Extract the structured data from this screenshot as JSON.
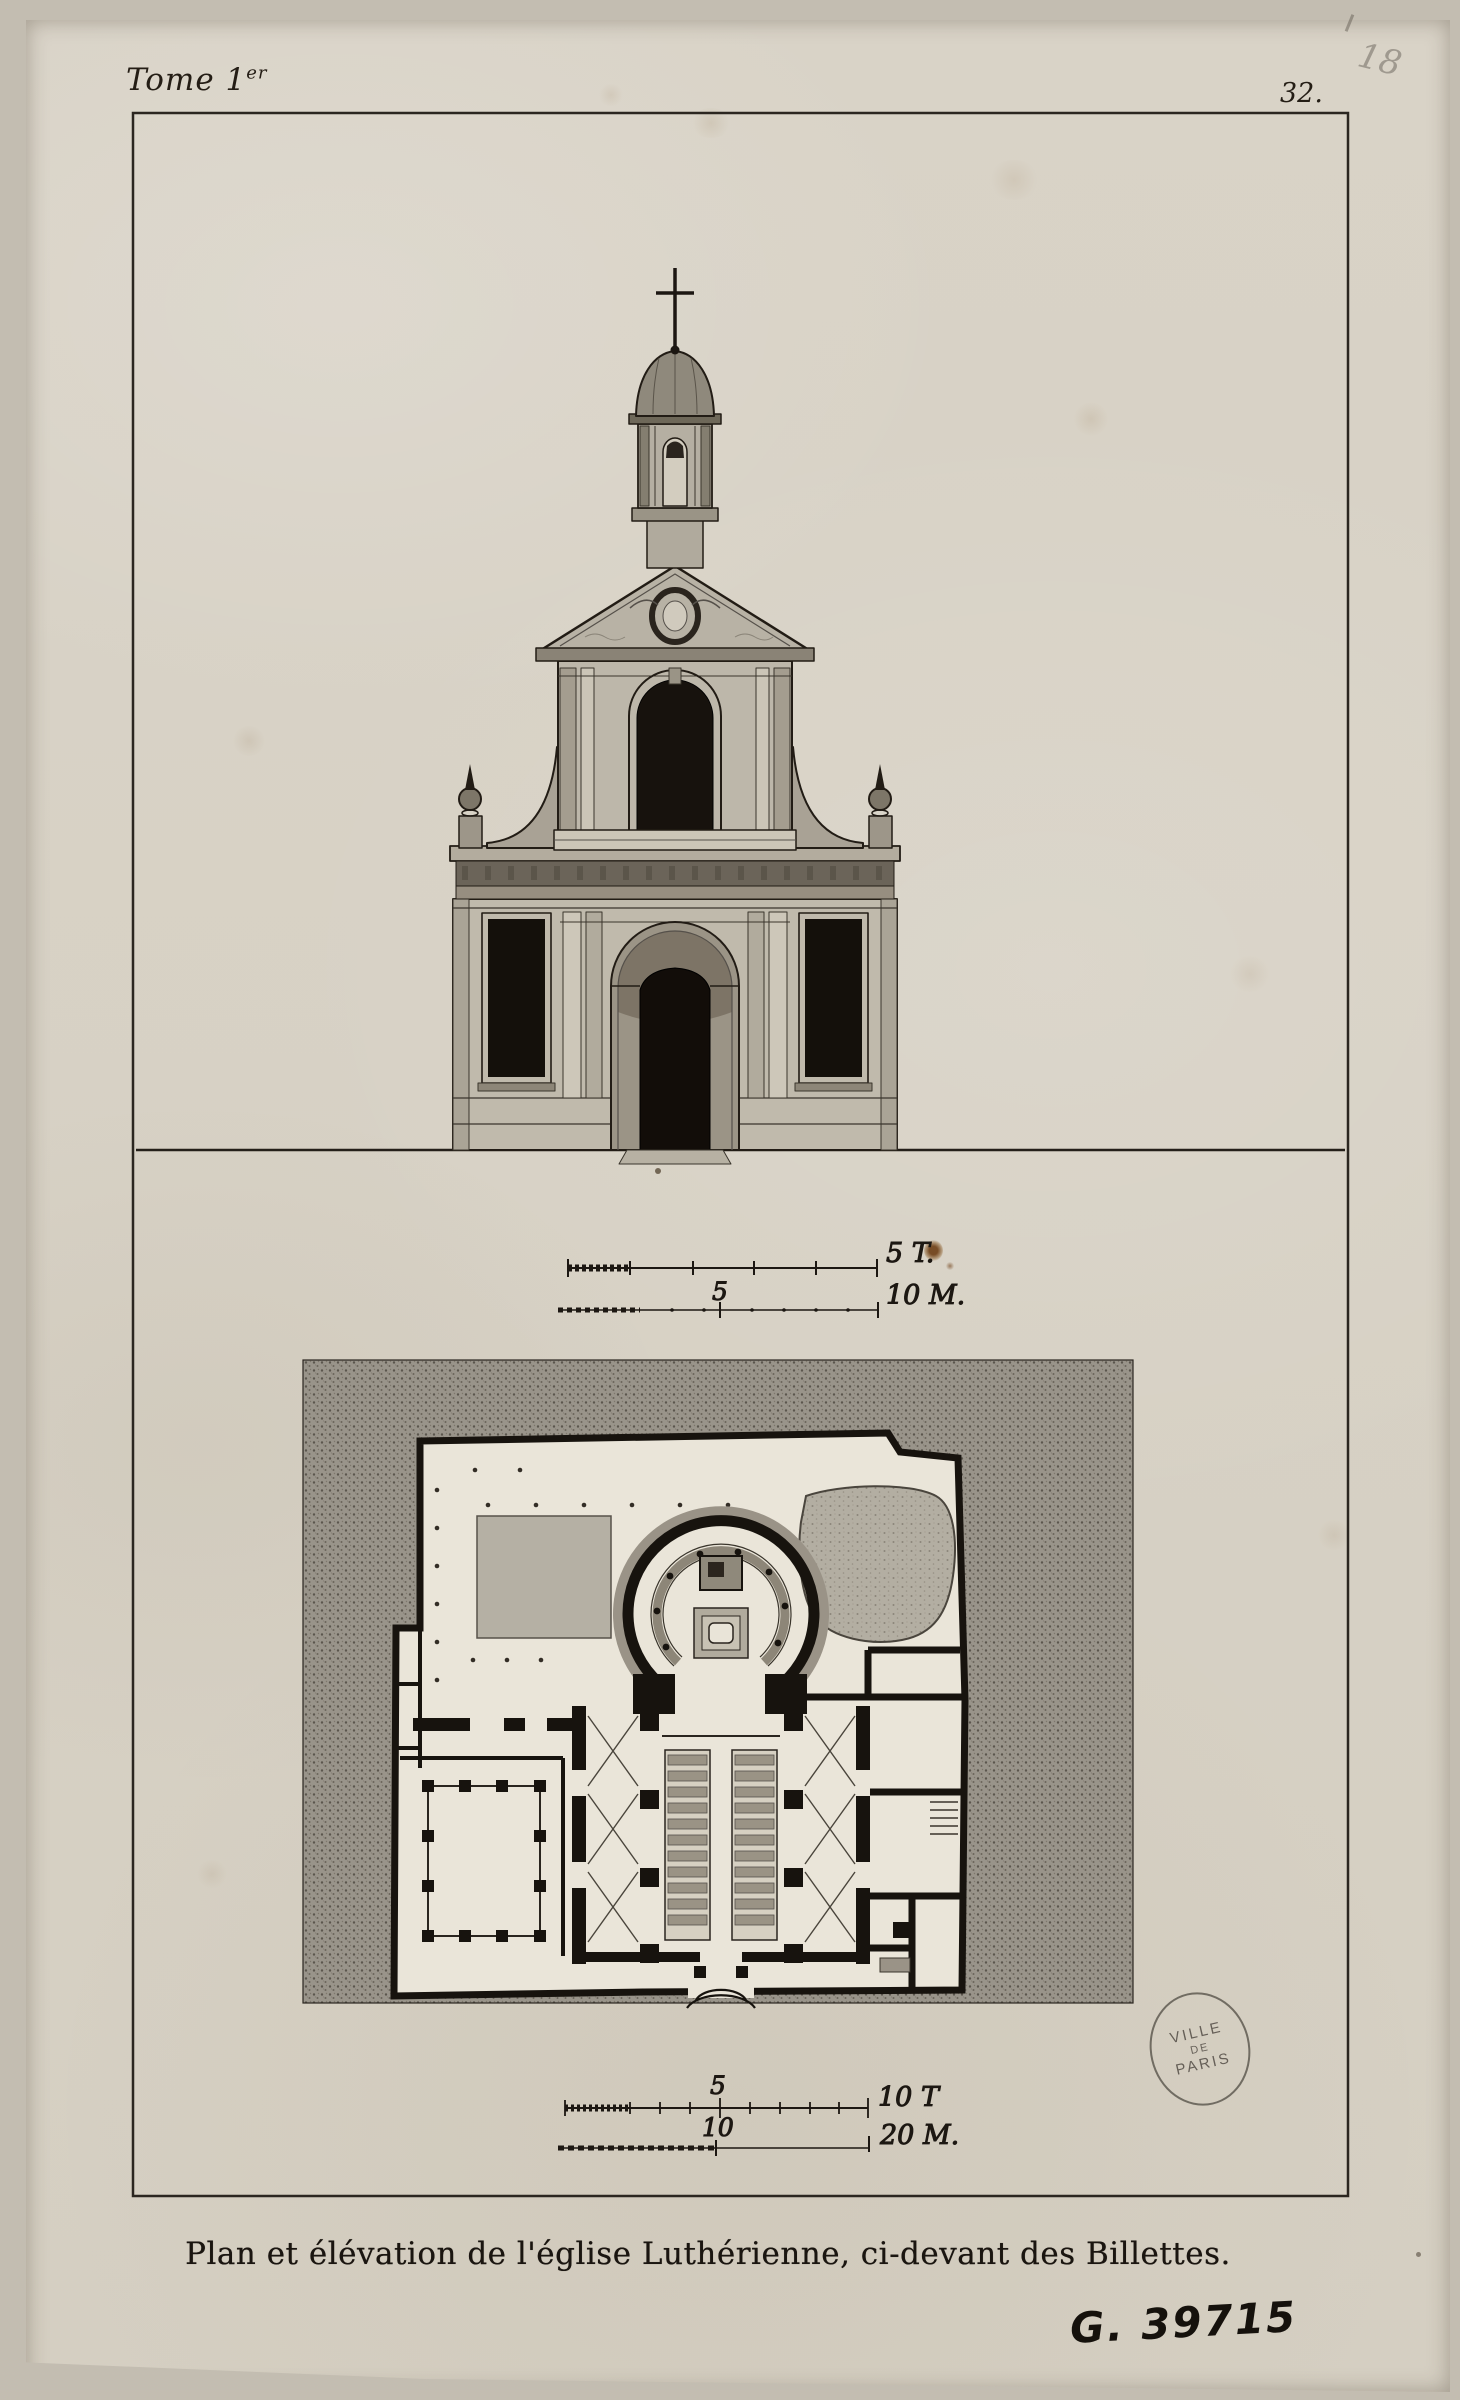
{
  "plate": {
    "tome_label": "Tome 1",
    "tome_superscript": "er",
    "page_number": "32.",
    "pencil_note": "18",
    "caption": "Plan et élévation de l'église Luthérienne, ci-devant des Billettes.",
    "catalog_number": "G. 39715"
  },
  "stamp": {
    "line1": "VILLE",
    "line2": "DE",
    "line3": "PARIS"
  },
  "scales": {
    "elevation": {
      "toise_end_label": "5 T.",
      "meter_mid_label": "5",
      "meter_end_label": "10 M."
    },
    "plan": {
      "toise_mid_label": "5",
      "toise_end_label": "10 T",
      "meter_mid_label": "10",
      "meter_end_label": "20 M."
    }
  },
  "colors": {
    "paper": "#d9d3c7",
    "ink": "#1c1712",
    "wash_light": "#c0baac",
    "wash_dark": "#6b655a",
    "stipple_ground": "#99948a",
    "stamp_ink": "#4a453e",
    "rust_spot": "#7a4a1c"
  }
}
